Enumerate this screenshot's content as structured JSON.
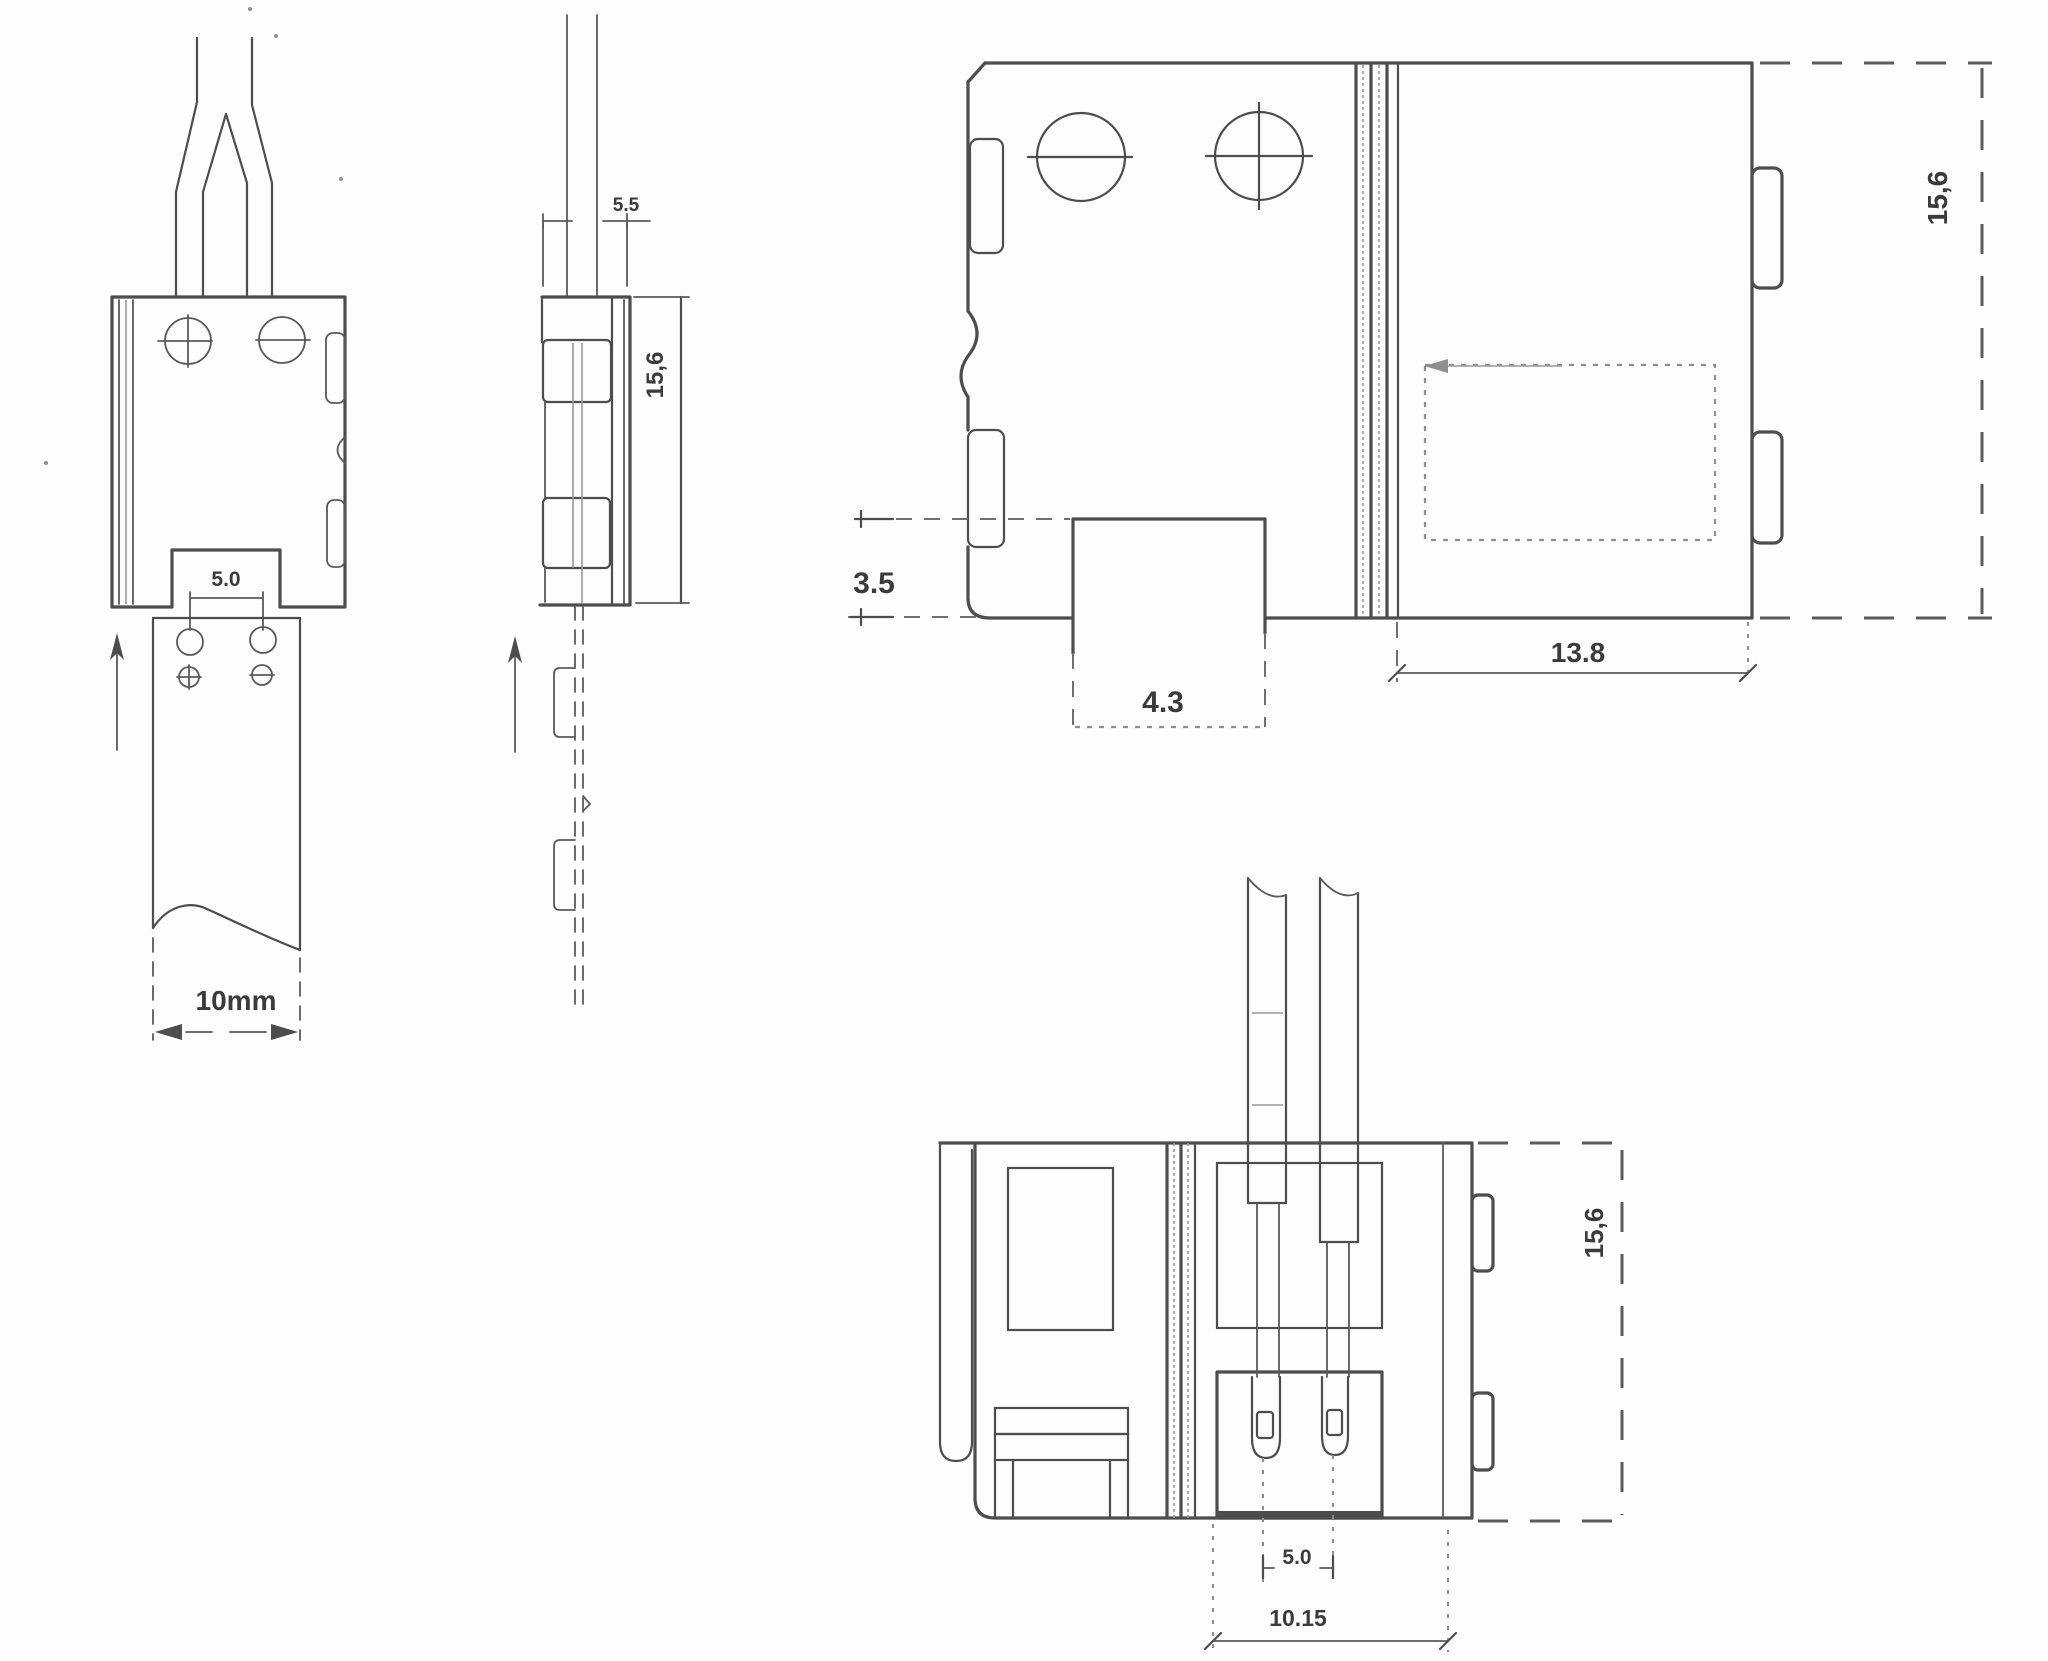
{
  "drawing": {
    "type": "technical-dimension-drawing",
    "subject": "LED strip clip-on connector, four orthographic views",
    "units": "mm",
    "line_color": "#4d4d4d",
    "label_color": "#3b3b3b",
    "background_color": "#fdfdfd"
  },
  "front_view": {
    "title": "front view with LED strip and wires",
    "dims": {
      "pad_notch": "5.0",
      "strip_width": "10mm"
    },
    "symbols": {
      "positive_pad": "plus-in-circle",
      "negative_pad": "minus-in-circle",
      "insert_direction": "up-arrow"
    }
  },
  "side_view": {
    "title": "side profile view",
    "dims": {
      "wire_offset": "5.5",
      "height": "15,6"
    },
    "symbols": {
      "insert_direction": "up-arrow"
    }
  },
  "plan_view": {
    "title": "top plan view",
    "dims": {
      "height": "15,6",
      "latch_depth": "3.5",
      "tab_width": "4.3",
      "cover_width": "13.8"
    },
    "symbols": {
      "screw_left": "minus-screw",
      "screw_right": "cross-screw"
    }
  },
  "bottom_view": {
    "title": "bottom plan view with wires and terminals",
    "dims": {
      "height": "15,6",
      "terminal_pitch": "5.0",
      "block_width": "10.15"
    }
  }
}
